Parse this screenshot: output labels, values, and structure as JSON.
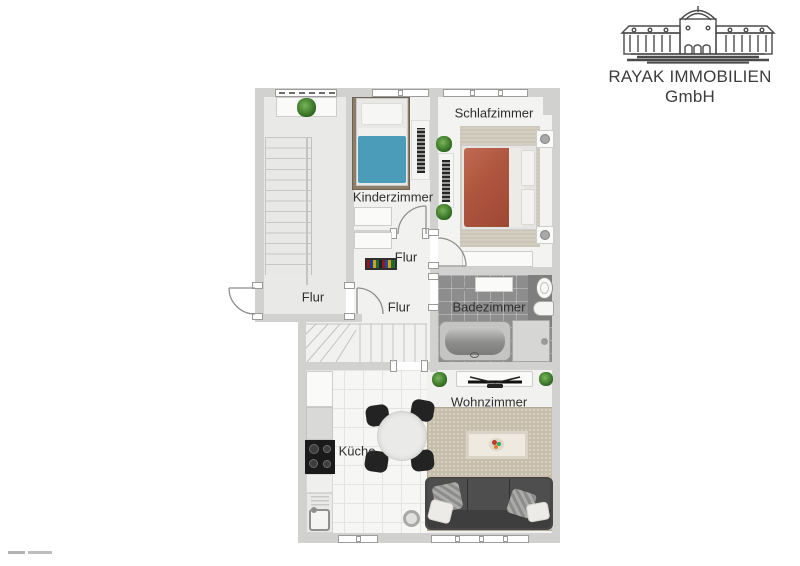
{
  "brand": {
    "name": "RAYAK IMMOBILIEN GmbH"
  },
  "logo": {
    "icon": "palace-facade-icon"
  },
  "floorplan": {
    "rooms": {
      "schlafzimmer": {
        "label": "Schlafzimmer"
      },
      "kinderzimmer": {
        "label": "Kinderzimmer"
      },
      "badezimmer": {
        "label": "Badezimmer"
      },
      "wohnzimmer": {
        "label": "Wohnzimmer"
      },
      "kueche": {
        "label": "Küche"
      },
      "flur_treppenhaus": {
        "label": "Flur"
      },
      "flur_mitte": {
        "label": "Flur"
      },
      "flur_unten": {
        "label": "Flur"
      }
    },
    "furniture_icons": [
      "single-bed",
      "double-bed",
      "bathtub",
      "shower",
      "toilet",
      "sink",
      "sofa",
      "coffee-table",
      "dining-table",
      "stove",
      "kitchen-sink",
      "tv-sideboard",
      "wardrobe",
      "nightstand",
      "radiator",
      "plant",
      "staircase",
      "shoe-rack"
    ],
    "colors": {
      "wall": "#d1d1cf",
      "floor": "#f1f1ef",
      "single_bed": "#4a9cb8",
      "double_bed": "#b0563f",
      "bath_tiles": "#8d8d8d",
      "carpet": "#c7bdab",
      "sofa": "#474747",
      "plant_green": "#3d7a2a",
      "logo_gray": "#4a4a4a"
    }
  }
}
